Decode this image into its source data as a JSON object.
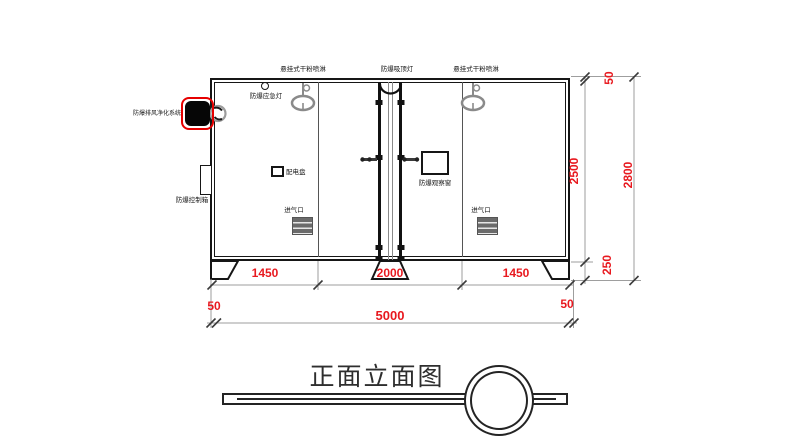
{
  "drawing_title": "正面立面图",
  "labels": {
    "sprinkler": "悬挂式干粉喷淋",
    "ceiling_light": "防爆吸顶灯",
    "emergency_light": "防爆应急灯",
    "purification_system": "防爆排风净化系统",
    "control_box": "防爆控制箱",
    "power_panel": "配电盘",
    "observation_window": "防爆观察窗",
    "air_inlet": "进气口"
  },
  "dimensions": {
    "seg_left": "1450",
    "seg_center": "2000",
    "seg_right": "1450",
    "total_width": "5000",
    "offset_left": "50",
    "offset_right": "50",
    "roof_offset": "50",
    "body_height": "2500",
    "base_height": "250",
    "total_height": "2800"
  },
  "colors": {
    "dimension_red": "#e8191f",
    "device_outline_red": "#e60000",
    "line_black": "#161616",
    "equipment_gray": "#8a8a8a"
  }
}
